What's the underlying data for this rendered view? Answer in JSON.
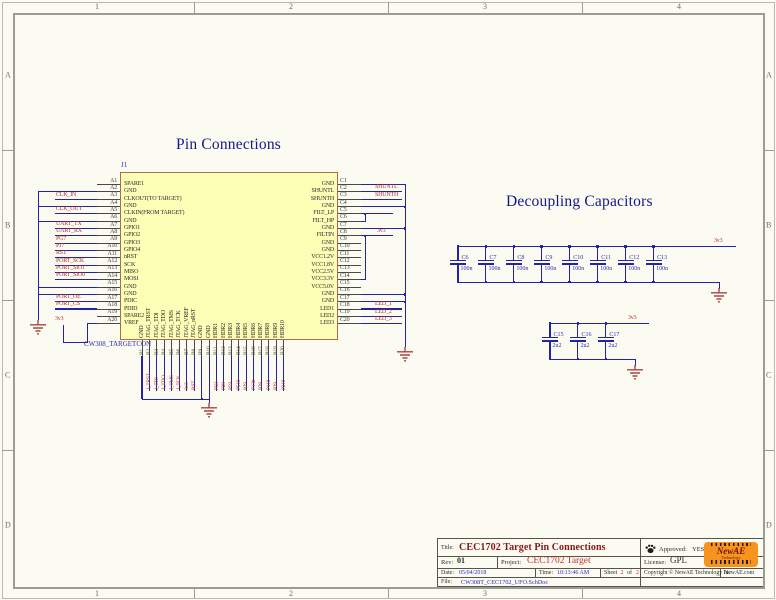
{
  "frame": {
    "top_zones": [
      "1",
      "2",
      "3",
      "4"
    ],
    "bottom_zones": [
      "1",
      "2",
      "3",
      "4"
    ],
    "left_zones": [
      "A",
      "B",
      "C",
      "D"
    ],
    "right_zones": [
      "A",
      "B",
      "C",
      "D"
    ]
  },
  "headings": {
    "pin_connections": "Pin Connections",
    "decoupling": "Decoupling Capacitors"
  },
  "connector": {
    "designator": "J1",
    "part_name": "CW308_TARGETCON",
    "vref_net": "3v3",
    "left_pins": [
      {
        "num": "A1",
        "name": "SPARE1",
        "net": "",
        "type": "plain"
      },
      {
        "num": "A2",
        "name": "GND",
        "net": "",
        "type": "gnd"
      },
      {
        "num": "A3",
        "name": "CLKOUT(TO TARGET)",
        "net": "CLK_IN",
        "type": "lbl"
      },
      {
        "num": "A4",
        "name": "GND",
        "net": "",
        "type": "gnd"
      },
      {
        "num": "A5",
        "name": "CLKIN(FROM TARGET)",
        "net": "CLK_OUT",
        "type": "lbl"
      },
      {
        "num": "A6",
        "name": "GND",
        "net": "",
        "type": "gnd"
      },
      {
        "num": "A7",
        "name": "GPIO1",
        "net": "UART_TX",
        "type": "lbl"
      },
      {
        "num": "A8",
        "name": "GPIO2",
        "net": "UART_RX",
        "type": "lbl"
      },
      {
        "num": "A9",
        "name": "GPIO3",
        "net": "PG7",
        "type": "lbl"
      },
      {
        "num": "A10",
        "name": "GPIO4",
        "net": "PJ7",
        "type": "lbl"
      },
      {
        "num": "A11",
        "name": "nRST",
        "net": "RST",
        "type": "lbl"
      },
      {
        "num": "A12",
        "name": "SCK",
        "net": "PORT_SCK",
        "type": "lbl"
      },
      {
        "num": "A13",
        "name": "MISO",
        "net": "PORT_SIO1",
        "type": "lbl"
      },
      {
        "num": "A14",
        "name": "MOSI",
        "net": "PORT_SIO0",
        "type": "lbl"
      },
      {
        "num": "A15",
        "name": "GND",
        "net": "",
        "type": "gnd"
      },
      {
        "num": "A16",
        "name": "GND",
        "net": "",
        "type": "gnd"
      },
      {
        "num": "A17",
        "name": "PDIC",
        "net": "PORT_OE",
        "type": "lbl"
      },
      {
        "num": "A18",
        "name": "PDID",
        "net": "PORT_CS",
        "type": "lbl"
      },
      {
        "num": "A19",
        "name": "SPARE2",
        "net": "",
        "type": "plain"
      },
      {
        "num": "A20",
        "name": "VREF",
        "net": "",
        "type": "plain"
      }
    ],
    "right_pins": [
      {
        "num": "C1",
        "name": "GND",
        "net": "",
        "type": "bus"
      },
      {
        "num": "C2",
        "name": "SHUNTL",
        "net": "SHUNTL",
        "type": "lbl"
      },
      {
        "num": "C3",
        "name": "SHUNTH",
        "net": "SHUNTH",
        "type": "lbl"
      },
      {
        "num": "C4",
        "name": "GND",
        "net": "",
        "type": "bus"
      },
      {
        "num": "C5",
        "name": "FILT_LP",
        "net": "",
        "type": "long"
      },
      {
        "num": "C6",
        "name": "FILT_HP",
        "net": "",
        "type": "short"
      },
      {
        "num": "C7",
        "name": "GND",
        "net": "",
        "type": "bus"
      },
      {
        "num": "C8",
        "name": "FILTIN",
        "net": "3v3",
        "type": "fil"
      },
      {
        "num": "C9",
        "name": "GND",
        "net": "",
        "type": "plain"
      },
      {
        "num": "C10",
        "name": "GND",
        "net": "",
        "type": "plain"
      },
      {
        "num": "C11",
        "name": "VCC1.2V",
        "net": "",
        "type": "plain"
      },
      {
        "num": "C12",
        "name": "VCC1.8V",
        "net": "",
        "type": "plain"
      },
      {
        "num": "C13",
        "name": "VCC2.5V",
        "net": "",
        "type": "plain"
      },
      {
        "num": "C14",
        "name": "VCC3.3V",
        "net": "",
        "type": "short"
      },
      {
        "num": "C15",
        "name": "VCC5.0V",
        "net": "",
        "type": "plain"
      },
      {
        "num": "C16",
        "name": "GND",
        "net": "",
        "type": "bus"
      },
      {
        "num": "C17",
        "name": "GND",
        "net": "",
        "type": "bus"
      },
      {
        "num": "C18",
        "name": "LED1",
        "net": "LED_1",
        "type": "lbl"
      },
      {
        "num": "C19",
        "name": "LED2",
        "net": "LED_2",
        "type": "lbl"
      },
      {
        "num": "C20",
        "name": "LED3",
        "net": "LED_3",
        "type": "lbl"
      }
    ],
    "bottom_pins": [
      {
        "num": "B1",
        "name": "GND",
        "net": "",
        "type": "gnd"
      },
      {
        "num": "B2",
        "name": "JTAG_TRST",
        "net": "J_TRST",
        "type": "plain"
      },
      {
        "num": "B3",
        "name": "JTAG_TDI",
        "net": "J_TDI",
        "type": "plain"
      },
      {
        "num": "B4",
        "name": "JTAG_TDO",
        "net": "J_TDO",
        "type": "plain"
      },
      {
        "num": "B5",
        "name": "JTAG_TMS",
        "net": "J_TMS",
        "type": "plain"
      },
      {
        "num": "B6",
        "name": "JTAG_TCK",
        "net": "J_TCK",
        "type": "plain"
      },
      {
        "num": "B7",
        "name": "JTAG_VREF",
        "net": "3v3",
        "type": "plain"
      },
      {
        "num": "B8",
        "name": "JTAG_nRST",
        "net": "RST",
        "type": "plain"
      },
      {
        "num": "B9",
        "name": "GND",
        "net": "",
        "type": "gnd"
      },
      {
        "num": "B10",
        "name": "GND",
        "net": "",
        "type": "gnd"
      },
      {
        "num": "B11",
        "name": "HDR1",
        "net": "P58",
        "type": "plain"
      },
      {
        "num": "B12",
        "name": "HDR2",
        "net": "P28",
        "type": "plain"
      },
      {
        "num": "B13",
        "name": "HDR3",
        "net": "P59",
        "type": "plain"
      },
      {
        "num": "B14",
        "name": "HDR4",
        "net": "P510",
        "type": "plain"
      },
      {
        "num": "B15",
        "name": "HDR5",
        "net": "P29",
        "type": "plain"
      },
      {
        "num": "B16",
        "name": "HDR6",
        "net": "P130",
        "type": "plain"
      },
      {
        "num": "B17",
        "name": "HDR7",
        "net": "P28",
        "type": "plain"
      },
      {
        "num": "B18",
        "name": "HDR8",
        "net": "P110",
        "type": "plain"
      },
      {
        "num": "B19",
        "name": "HDR9",
        "net": "P29",
        "type": "plain"
      },
      {
        "num": "B20",
        "name": "HDR10",
        "net": "P210",
        "type": "plain"
      }
    ]
  },
  "decoupling": {
    "group1": {
      "net": "3v3",
      "caps": [
        {
          "ref": "C6",
          "value": "100n"
        },
        {
          "ref": "C7",
          "value": "100n"
        },
        {
          "ref": "C8",
          "value": "100n"
        },
        {
          "ref": "C9",
          "value": "100n"
        },
        {
          "ref": "C10",
          "value": "100n"
        },
        {
          "ref": "C11",
          "value": "100n"
        },
        {
          "ref": "C12",
          "value": "100n"
        },
        {
          "ref": "C13",
          "value": "100n"
        }
      ]
    },
    "group2": {
      "net": "3v3",
      "caps": [
        {
          "ref": "C15",
          "value": "2u2"
        },
        {
          "ref": "C16",
          "value": "2u2"
        },
        {
          "ref": "C17",
          "value": "2u2"
        }
      ]
    }
  },
  "title_block": {
    "title_label": "Title:",
    "title": "CEC1702 Target Pin Connections",
    "approved_label": "Approved:",
    "approved": "YES",
    "rev_label": "Rev:",
    "rev": "01",
    "project_label": "Project:",
    "project": "CEC1702 Target",
    "license_label": "License:",
    "license": "GPL",
    "date_label": "Date:",
    "date": "05/04/2018",
    "time_label": "Time:",
    "time": "10:13:46 AM",
    "sheet_label": "Sheet",
    "sheet_num": "2",
    "sheet_of": "of",
    "sheet_total": "2",
    "copyright": "Copyright © NewAE Technology Inc",
    "website": "NewAE.com",
    "file_label": "File:",
    "file": "CW308T_CEC1702_UFO.SchDoc",
    "logo_text": "NewAE",
    "logo_sub": "Technology"
  },
  "colors": {
    "wire": "#2323a8",
    "net_label": "#b13030",
    "ground": "#a84444",
    "part_fill": "#feffb6",
    "heading": "#151591",
    "title_maroon": "#8a1616"
  }
}
